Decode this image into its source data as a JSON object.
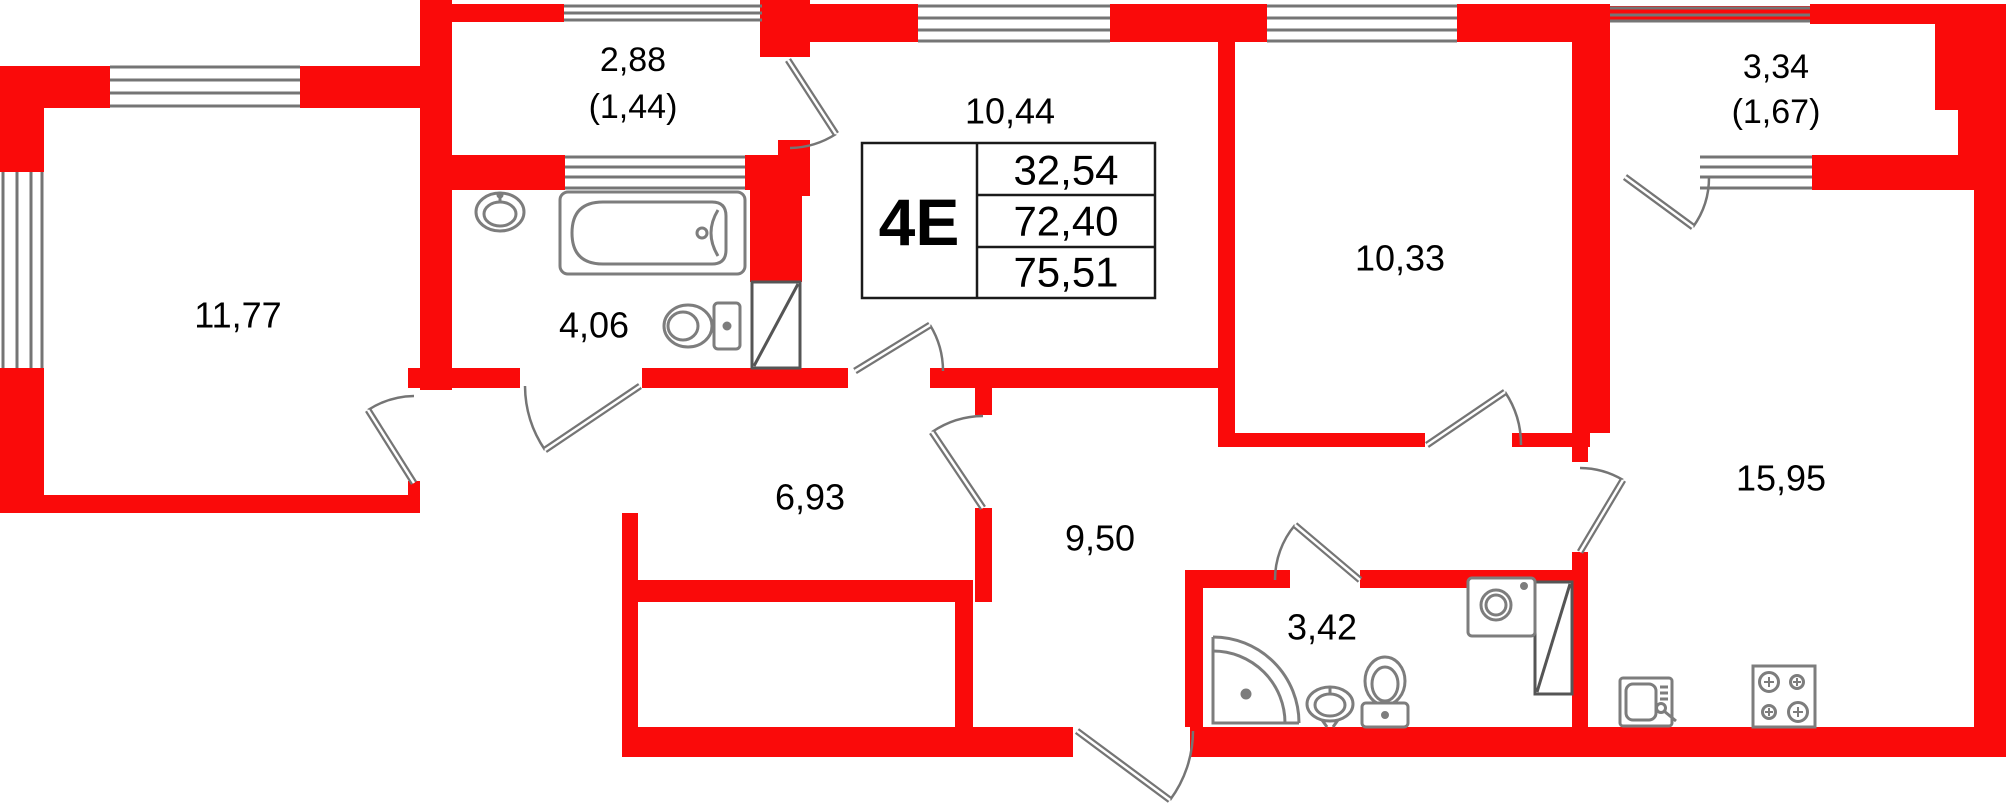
{
  "plan": {
    "type": "apartment-floor-plan",
    "unit": {
      "code": "4Е",
      "area_rows": [
        "32,54",
        "72,40",
        "75,51"
      ]
    },
    "rooms": [
      {
        "name": "room-1",
        "area": "11,77"
      },
      {
        "name": "balcony-1",
        "area": "2,88",
        "area_reduced": "(1,44)"
      },
      {
        "name": "bathroom",
        "area": "4,06"
      },
      {
        "name": "room-2",
        "area": "10,44"
      },
      {
        "name": "room-3",
        "area": "10,33"
      },
      {
        "name": "balcony-2",
        "area": "3,34",
        "area_reduced": "(1,67)"
      },
      {
        "name": "kitchen-living-room",
        "area": "15,95"
      },
      {
        "name": "corridor",
        "area": "6,93"
      },
      {
        "name": "hall",
        "area": "9,50"
      },
      {
        "name": "shower-room",
        "area": "3,42"
      }
    ],
    "fixtures": [
      "bathtub",
      "wash-basin",
      "toilet",
      "vent-shaft",
      "shower-cabin",
      "pedestal-sink",
      "washing-machine",
      "kitchen-sink",
      "stove"
    ],
    "colors": {
      "wall": "#fa0a0a",
      "lines": "#757575",
      "text": "#000000"
    }
  }
}
